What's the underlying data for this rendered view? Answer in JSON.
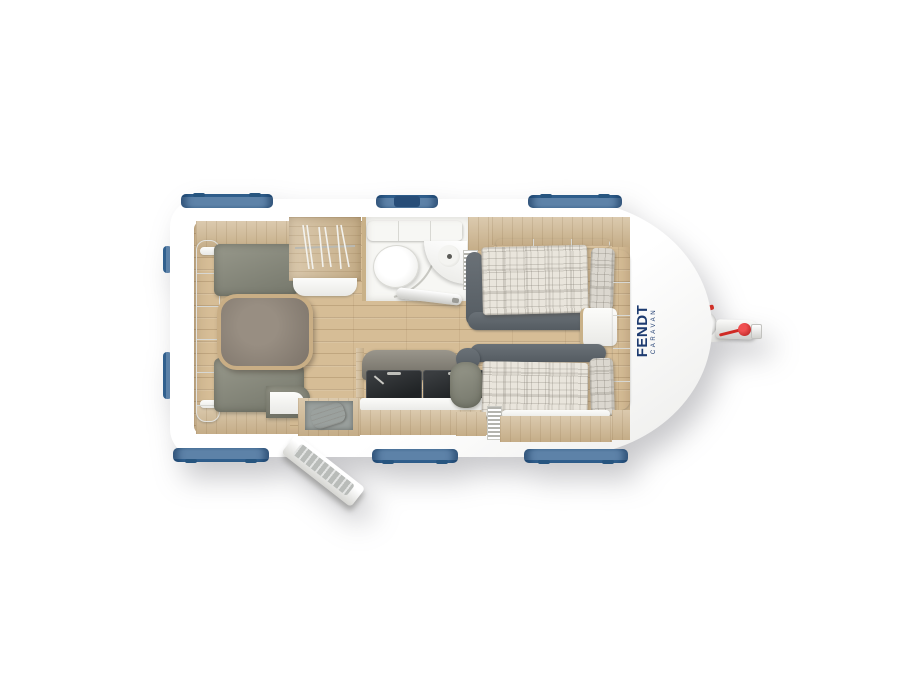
{
  "branding": {
    "name": "FENDT",
    "sub": "CARAVAN",
    "color": "#1d3b70"
  },
  "palette": {
    "body_white": "#ffffff",
    "window_blue": "#5d82a8",
    "window_blue_dark": "#27557f",
    "furniture_wood": "#cfb893",
    "floor_wood": "#d6bd96",
    "cushion_gray": "#8a8b80",
    "bolster_gray": "#5d646a",
    "plaid_base": "#e9e5dc",
    "hitch_red": "#d03028"
  },
  "floorplan": {
    "vehicle": "caravan",
    "view": "top-down-floor-plan",
    "zones": {
      "rear_lounge": [
        "backrest-cushions",
        "bench-seat-top",
        "bench-seat-bottom",
        "dining-table",
        "overhead-lockers"
      ],
      "wardrobe": [
        "clothes-rail",
        "hangers",
        "shelf"
      ],
      "washroom": [
        "top-cabinet",
        "toilet",
        "corner-washbasin",
        "shower-screen",
        "washroom-door-open"
      ],
      "kitchen": [
        "backsplash",
        "sink-unit",
        "hob-unit",
        "worktop",
        "entry-mat",
        "entry-step",
        "entrance-door-open"
      ],
      "front_bedroom": [
        "single-bed-top",
        "single-bed-bottom",
        "pillow-top",
        "pillow-bottom",
        "bolsters",
        "bedside-console",
        "overhead-lockers",
        "heater-fins"
      ],
      "chassis": [
        "drawbar",
        "jockey-wheel-hub",
        "coupling",
        "red-coupling-knob",
        "red-lever"
      ]
    },
    "window_count": {
      "top": 3,
      "bottom": 3,
      "rear": 2
    },
    "hanger_count": 6
  }
}
